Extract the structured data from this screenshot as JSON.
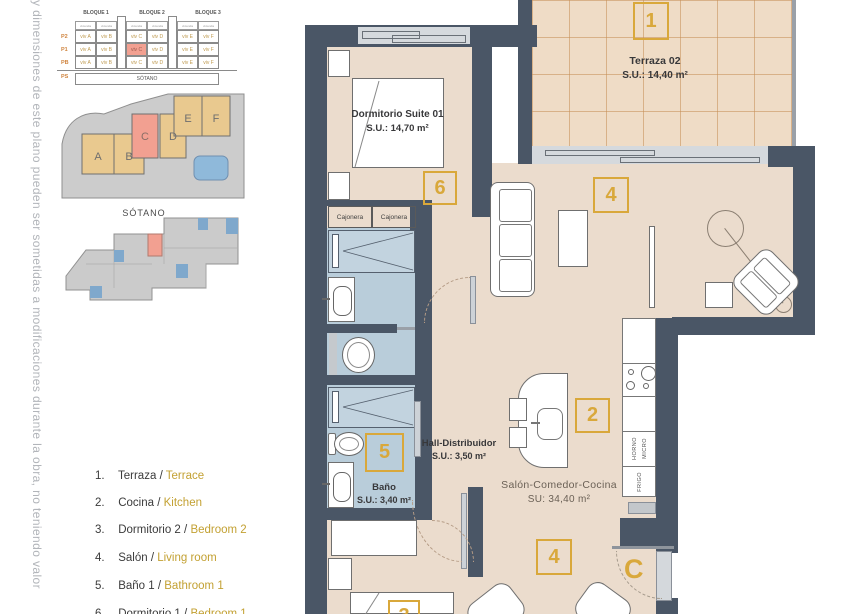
{
  "side_note": "y dimensiones de este plano pueden ser sometidas a modificaciones durante la obra, no teniendo valor",
  "block_table": {
    "blocks": [
      "BLOQUE 1",
      "BLOQUE 2",
      "BLOQUE 3"
    ],
    "sub": "vivienda",
    "floors": [
      "P2",
      "P1",
      "PB"
    ],
    "rows": [
      [
        "viv A",
        "viv B",
        "viv C",
        "viv D",
        "viv E",
        "viv F"
      ],
      [
        "viv A",
        "viv B",
        "viv C",
        "viv D",
        "viv E",
        "viv F"
      ],
      [
        "viv A",
        "viv B",
        "viv C",
        "viv D",
        "viv E",
        "viv F"
      ]
    ],
    "basement_floor": "PS",
    "basement": "SÓTANO"
  },
  "site": {
    "labels": [
      "A",
      "B",
      "C",
      "D",
      "E",
      "F"
    ]
  },
  "basement": {
    "title": "SÓTANO"
  },
  "legend": {
    "separator": "/",
    "items": [
      {
        "num": "1.",
        "es": "Terraza",
        "en": "Terrace"
      },
      {
        "num": "2.",
        "es": "Cocina",
        "en": "Kitchen"
      },
      {
        "num": "3.",
        "es": "Dormitorio 2",
        "en": "Bedroom 2"
      },
      {
        "num": "4.",
        "es": "Salón",
        "en": "Living room"
      },
      {
        "num": "5.",
        "es": "Baño 1",
        "en": "Bathroom 1"
      },
      {
        "num": "6.",
        "es": "Dormitorio 1",
        "en": "Bedroom 1"
      }
    ]
  },
  "plan": {
    "terraza": {
      "tag": "1",
      "name": "Terraza 02",
      "area": "S.U.: 14,40 m²"
    },
    "dormitorio": {
      "tag": "6",
      "name": "Dormitorio Suite 01",
      "area": "S.U.: 14,70 m²"
    },
    "hall": {
      "name": "Hall-Distribuidor",
      "area": "S.U.: 3,50 m²"
    },
    "bano": {
      "tag": "5",
      "name": "Baño",
      "area": "S.U.: 3,40 m²"
    },
    "salon": {
      "tag": "2",
      "name": "Salón-Comedor-Cocina",
      "area": "SU: 34,40 m²"
    },
    "living_tag": "4",
    "dining_tag": "4",
    "bedroom2_tag": "3",
    "entry_tag": "C",
    "cajonera": "Cajonera",
    "kitchen": {
      "horno": "HORNO",
      "micro": "MICRO",
      "frigo": "FRIGO"
    }
  },
  "colors": {
    "accent_gold": "#d9a83b",
    "legend_en": "#c3a133",
    "wall": "#4a5666",
    "floor": "#ebdccd",
    "terrace": "#efdcc6",
    "bathroom": "#b9cdda",
    "highlight_red": "#f2a091",
    "pool_blue": "#8fb9da"
  }
}
